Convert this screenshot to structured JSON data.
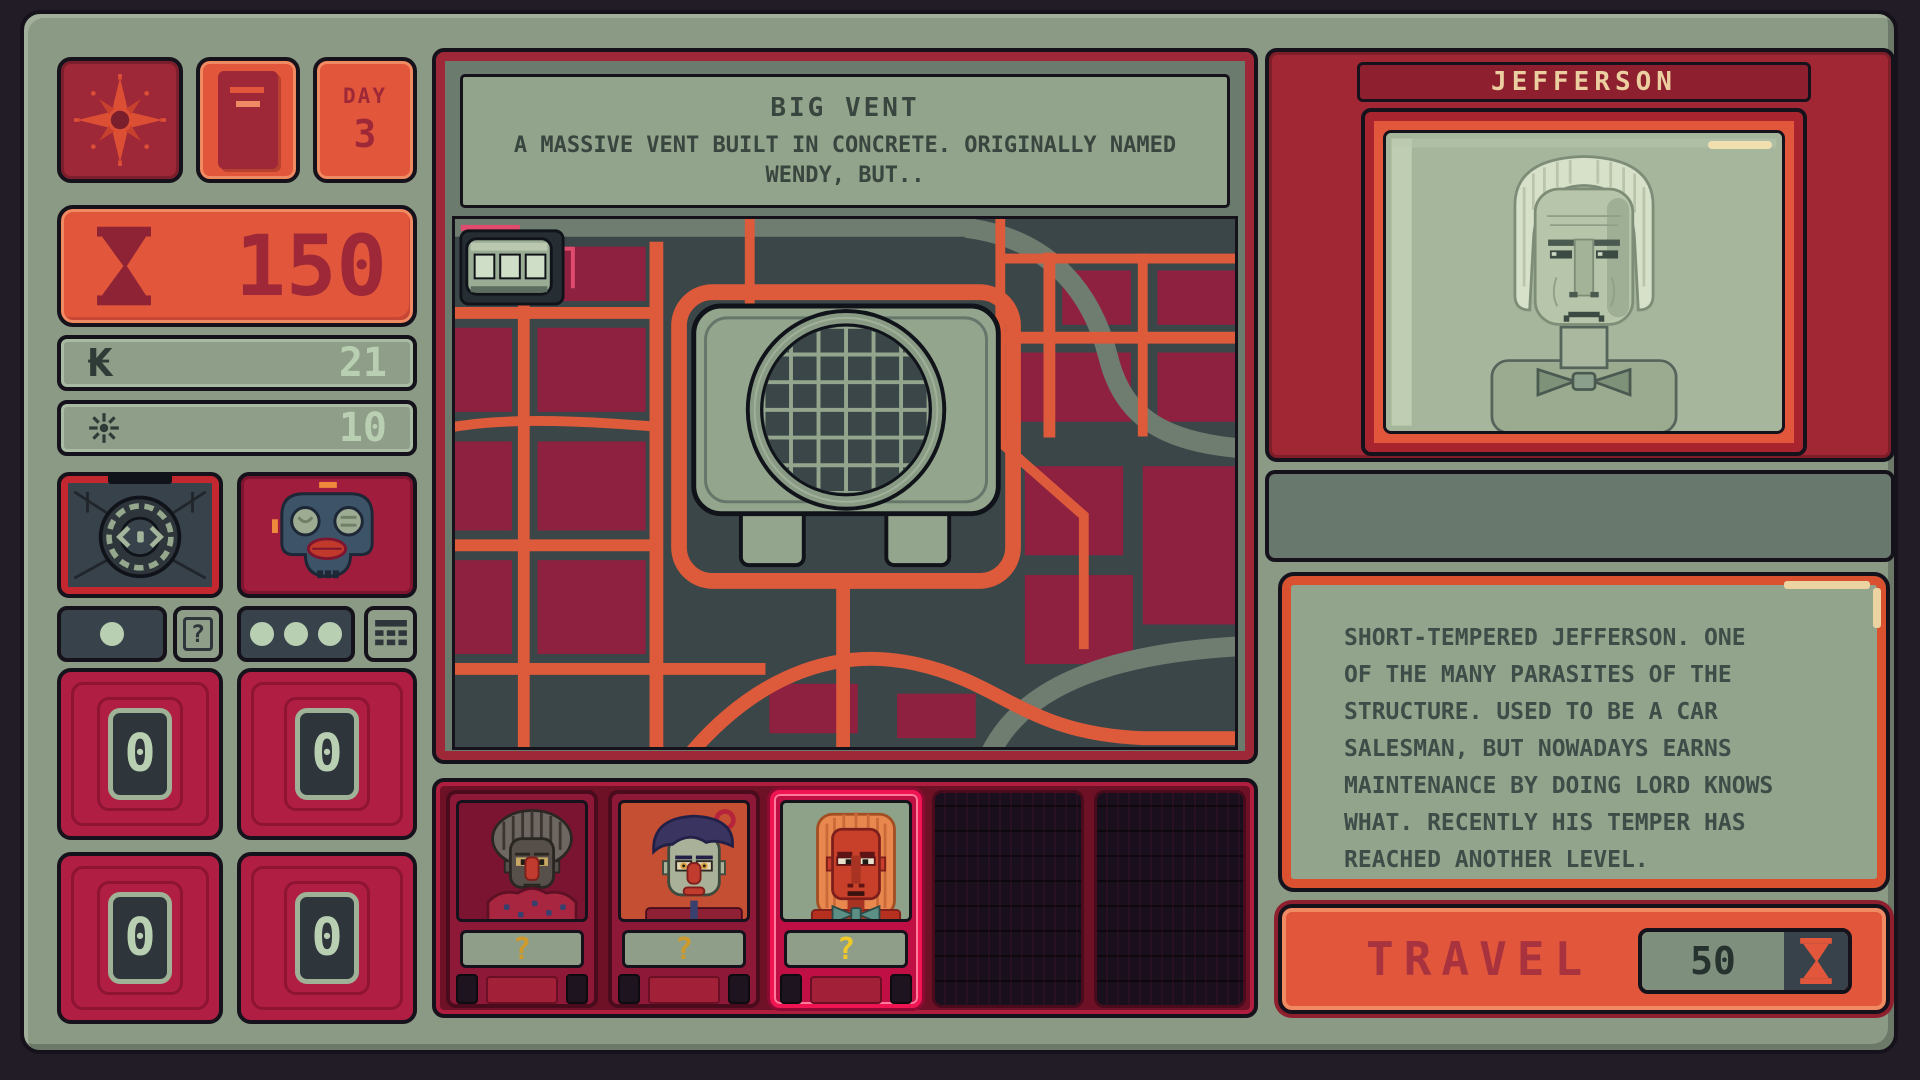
{
  "hud": {
    "day_label": "DAY",
    "day_value": "3",
    "time_value": "150",
    "currency_value": "21",
    "energy_value": "10",
    "counters": [
      "0",
      "0",
      "0",
      "0"
    ]
  },
  "icons": {
    "compass": "compass-rose",
    "document": "document",
    "time": "hourglass",
    "currency": "₭",
    "energy": "sun-spark",
    "left_gadget": "radar-device",
    "right_gadget": "mask-device",
    "query": "?",
    "grid": "grid-table"
  },
  "location": {
    "title": "BIG VENT",
    "description": "A MASSIVE VENT BUILT IN CONCRETE. ORIGINALLY NAMED\nWENDY, BUT.."
  },
  "party": {
    "slot_labels": [
      "?",
      "?",
      "?"
    ]
  },
  "character": {
    "name": "JEFFERSON",
    "description": "SHORT-TEMPERED JEFFERSON. ONE\nOF THE MANY PARASITES OF THE\nSTRUCTURE. USED TO BE A CAR\nSALESMAN, BUT NOWADAYS EARNS\nMAINTENANCE BY DOING LORD KNOWS\nWHAT. RECENTLY HIS TEMPER HAS\nREACHED ANOTHER LEVEL."
  },
  "travel": {
    "label": "TRAVEL",
    "cost": "50"
  },
  "colors": {
    "frame_green": "#8a9a84",
    "background": "#211c26",
    "orange": "#e2573b",
    "dark_red": "#9e2837",
    "crimson": "#b01e44",
    "slate": "#3b4649",
    "sage_panel": "#93a48c",
    "mint": "#b9cfb2",
    "cream": "#eccfa0",
    "query_yellow": "#cf9a2c",
    "selected_red": "#f01552",
    "street_orange": "#dd5a3a",
    "block_crimson": "#8e2040"
  }
}
